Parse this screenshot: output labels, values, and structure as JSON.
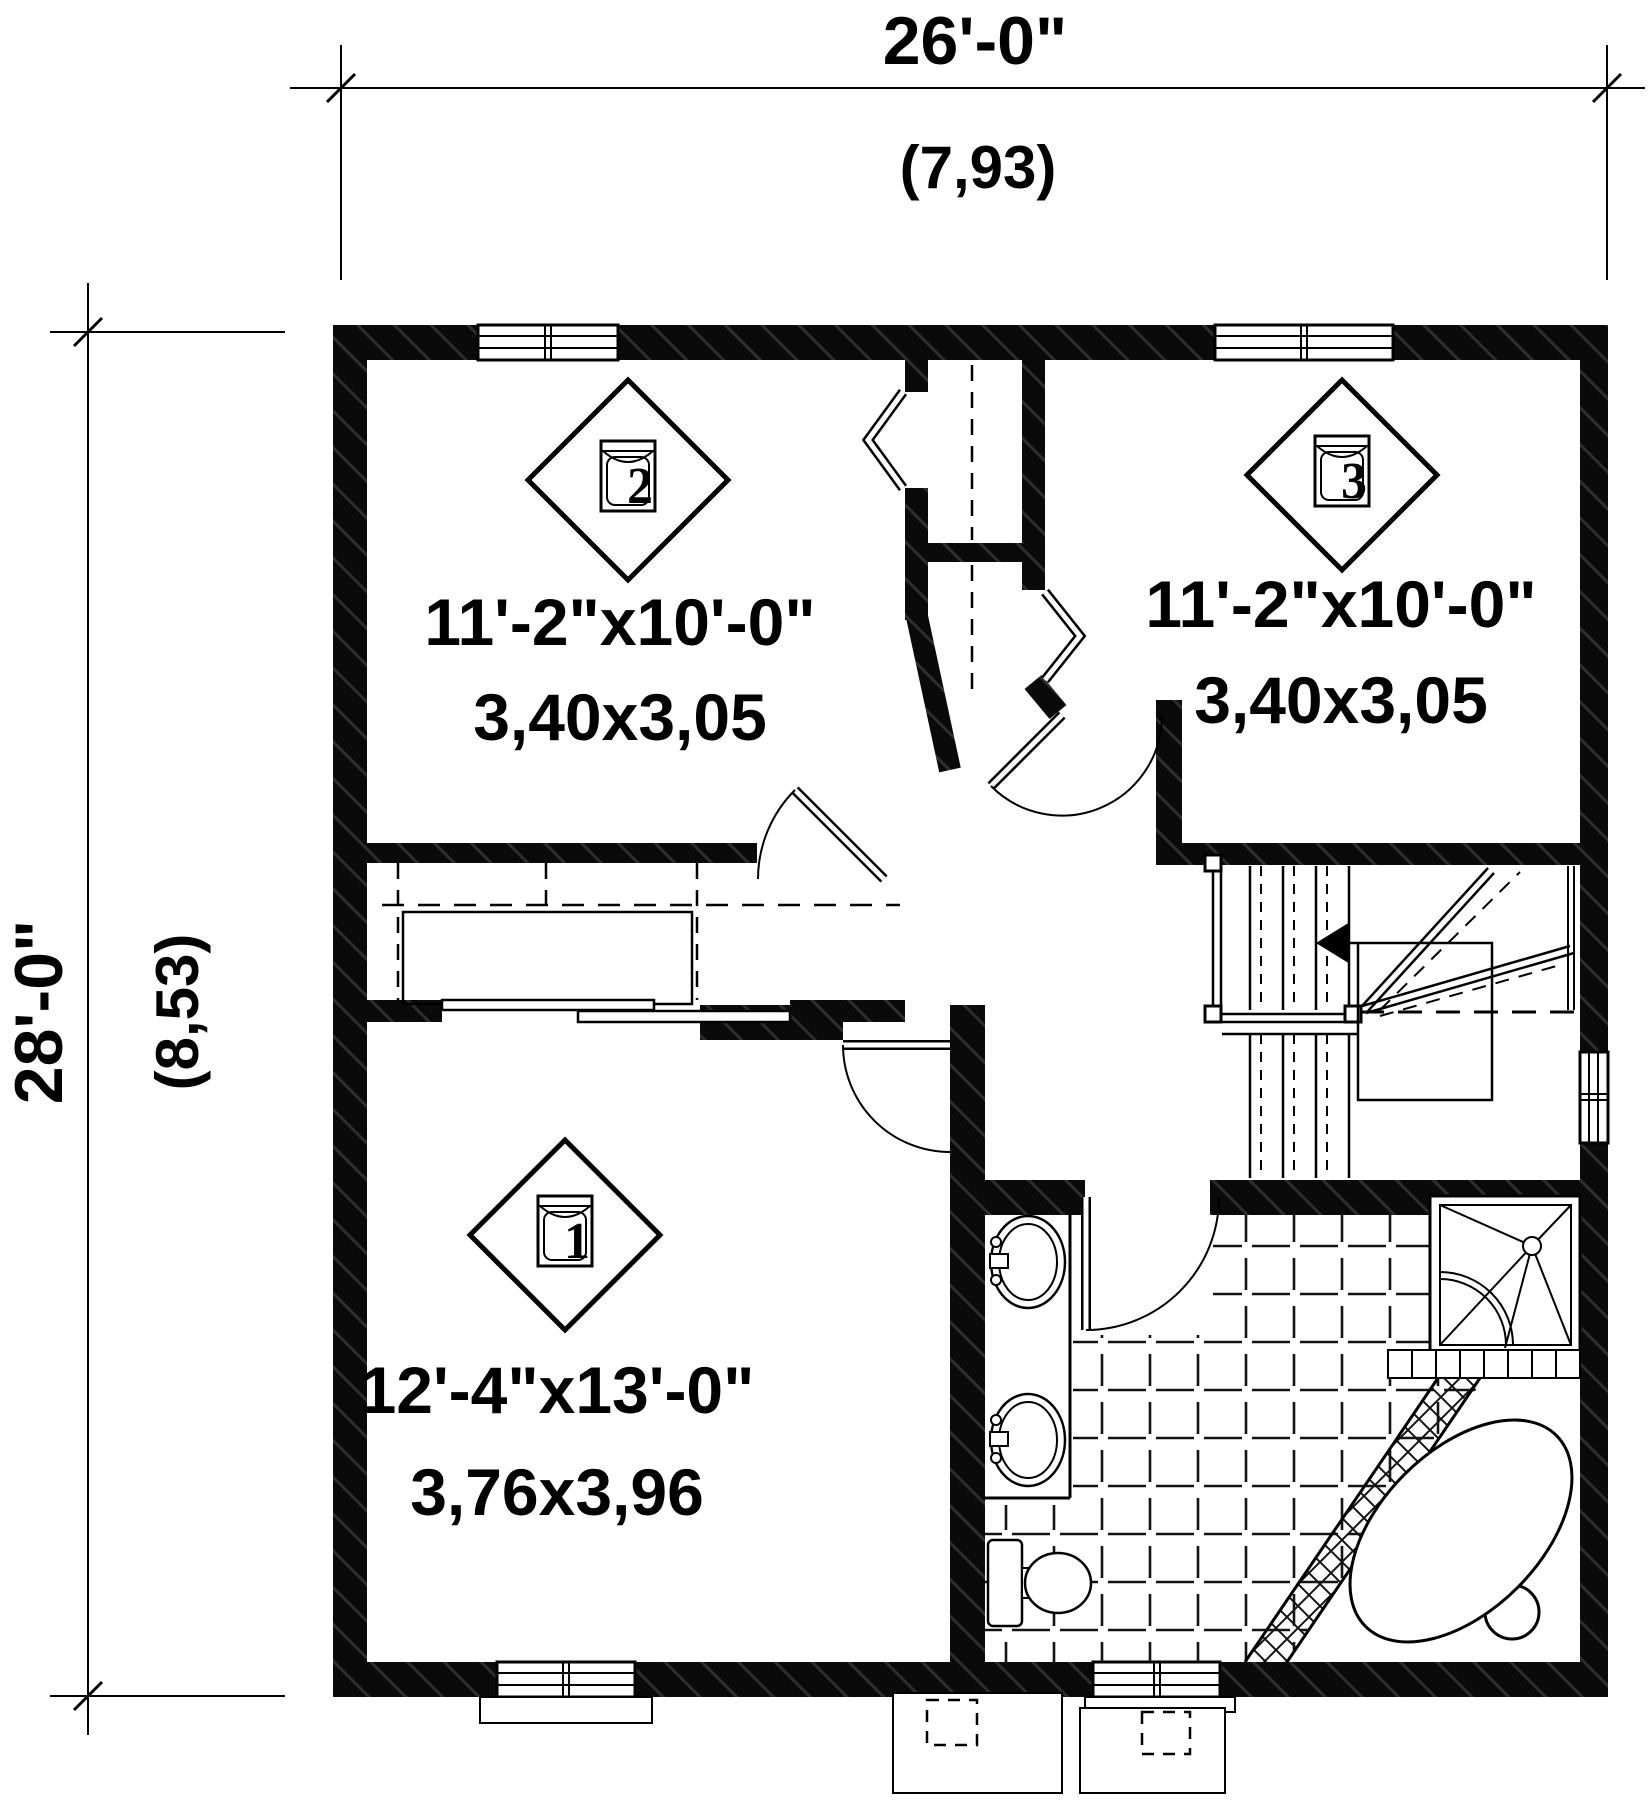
{
  "plan": {
    "type": "floor-plan",
    "dimensions": {
      "top": {
        "feet": "26'-0\"",
        "meters": "(7,93)"
      },
      "left": {
        "feet": "28'-0\"",
        "meters": "(8,53)"
      }
    },
    "rooms": {
      "bedroom2": {
        "number": "2",
        "feet": "11'-2\"x10'-0\"",
        "meters": "3,40x3,05"
      },
      "bedroom3": {
        "number": "3",
        "feet": "11'-2\"x10'-0\"",
        "meters": "3,40x3,05"
      },
      "bedroom1": {
        "number": "1",
        "feet": "12'-4\"x13'-0\"",
        "meters": "3,76x3,96"
      }
    },
    "fixtures": [
      "double-sink-vanity",
      "toilet",
      "corner-shower",
      "garden-tub",
      "winder-staircase",
      "closets"
    ],
    "icons": {
      "stair_direction": "left-arrow",
      "room_marker": "diamond-bed-symbol"
    },
    "colors": {
      "ink": "#000000",
      "paper": "#ffffff"
    }
  }
}
